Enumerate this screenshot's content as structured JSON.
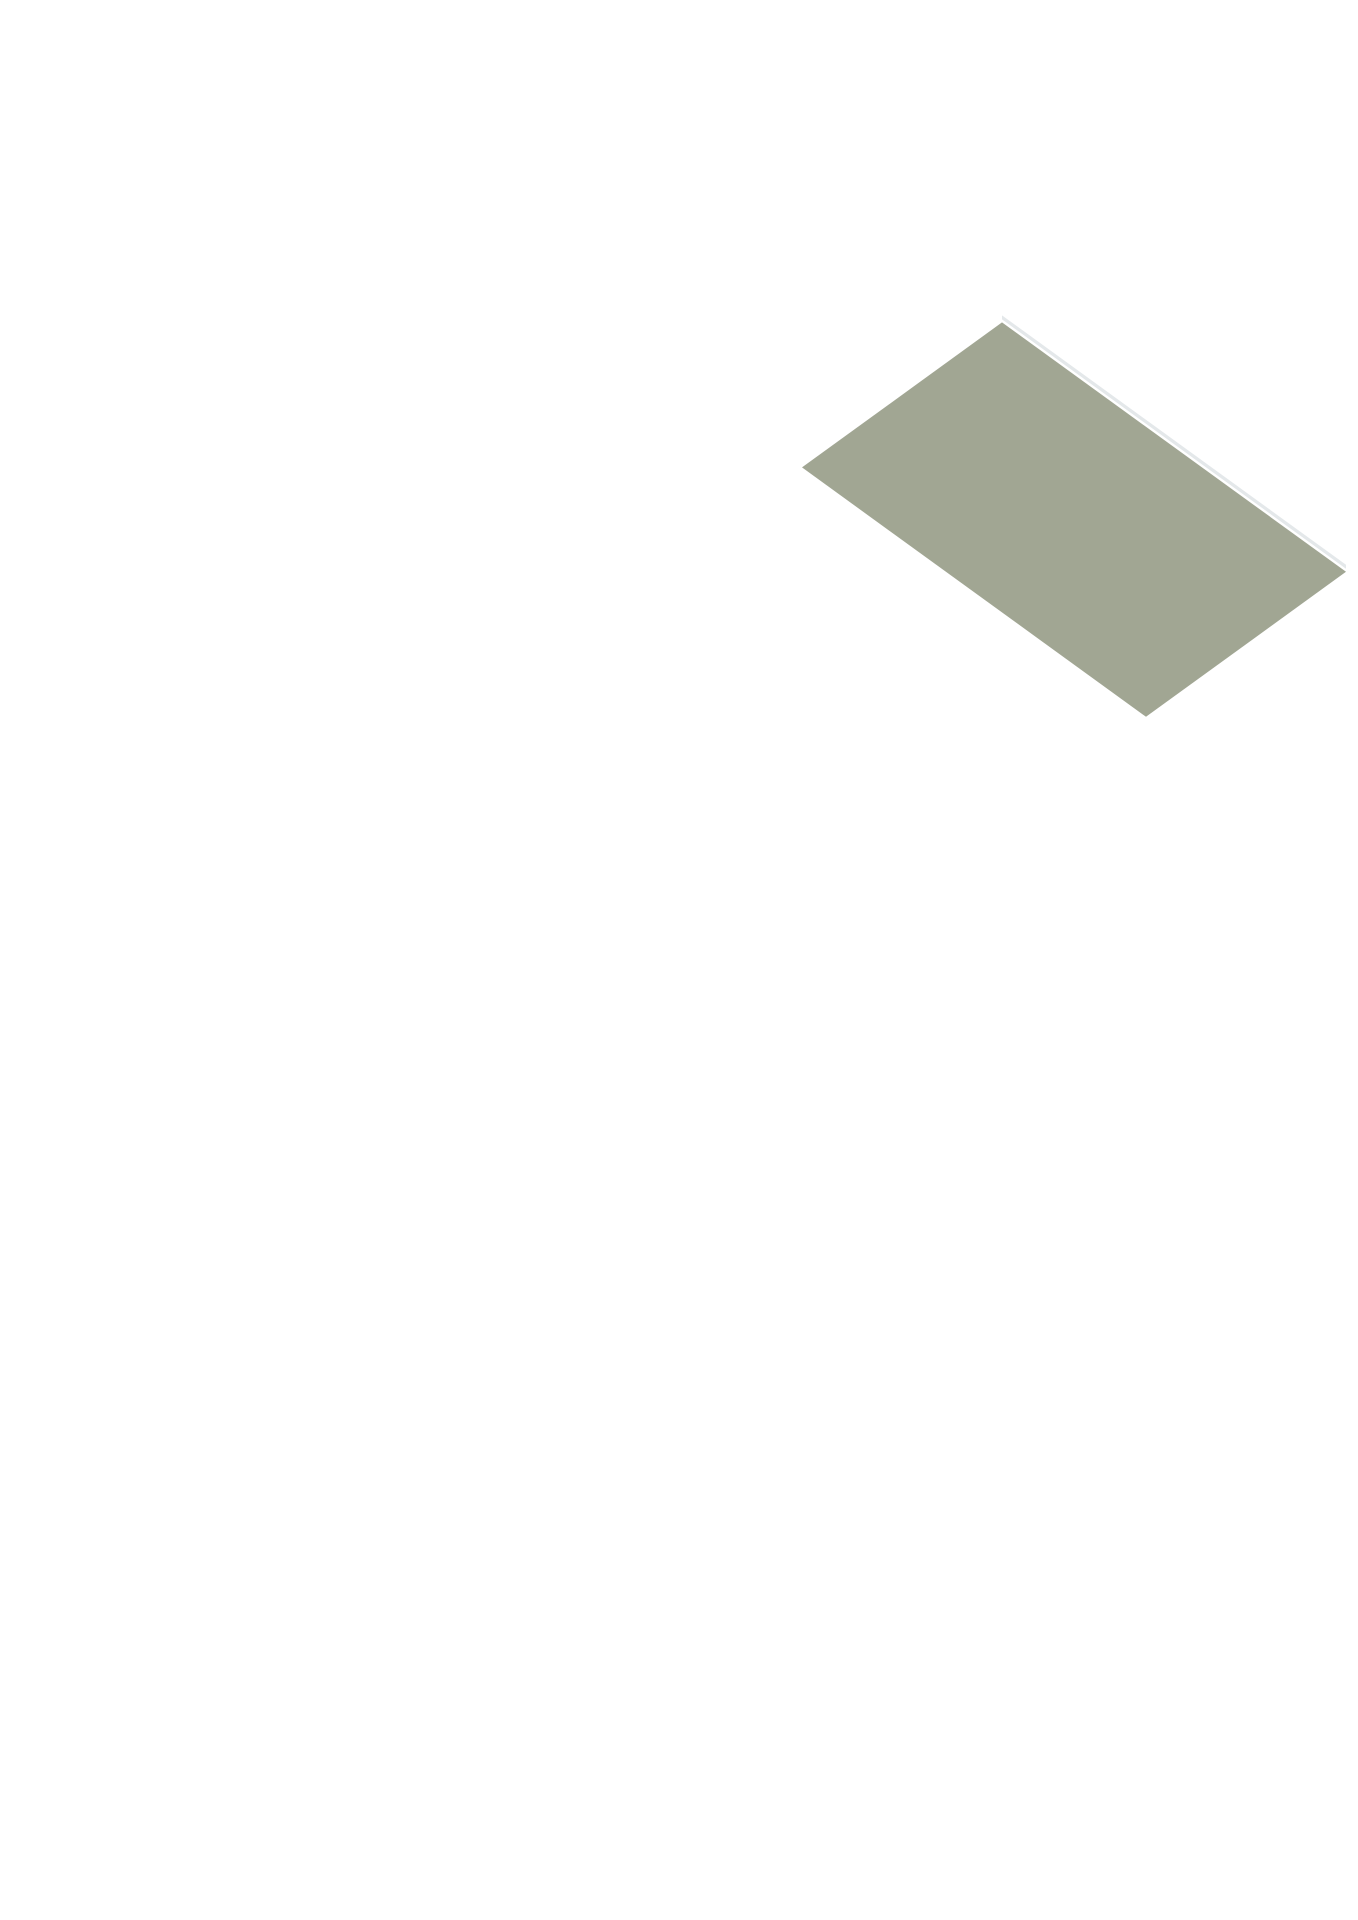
{
  "image": {
    "kind": "3d-floorplan-render",
    "background": "#ffffff"
  },
  "projection": {
    "ox": 778,
    "oy": 450,
    "ax": 0.8,
    "ay": 0.58
  },
  "colors": {
    "wallTop": "#303236",
    "extGray": "#c6c9cc",
    "intWhite": "#f3f4f6",
    "intGray": "#c0c4c7",
    "neInner": "#d0d3d5",
    "floorLiving": "#dfc8a2",
    "floorBed": "#d8bf95",
    "floorCorr": "#d9c098",
    "floorKitchen": "#ccd6de",
    "floorBath": "#c7d2dd",
    "floorTerrace": "#a1a693",
    "floorBalcony": "#d9dbdc",
    "glass": "#b4b8ab",
    "pane": "#eef1f3",
    "paneTan": "#d9c39b",
    "frame": "#ffffff",
    "door": "#e8eaeb",
    "doorGray": "#d9dcde",
    "rail": "#e4e8ea",
    "post": "#dde2e4",
    "white": "#f5f6f7",
    "boxFace": "#eceeef",
    "boxSide": "#e2e4e6",
    "stepFront": "#dfe2e4",
    "stepSide": "#d4d7d9",
    "applianceDark": "#27272a",
    "boilerFront": "#3c2b28",
    "boilerAccent": "#a33a2c",
    "handle": "#8e9498"
  },
  "scene": [
    {
      "t": "floor",
      "n": "terrace-floor",
      "pts": [
        [
          30,
          -250
        ],
        [
          460,
          -250
        ],
        [
          460,
          0
        ],
        [
          30,
          0
        ]
      ],
      "fill": "floorTerrace"
    },
    {
      "t": "rail",
      "n": "terrace-railing-nw",
      "axis": "x",
      "c": -250,
      "a1": 30,
      "a2": 460,
      "h": 55
    },
    {
      "t": "rail",
      "n": "terrace-railing-west",
      "axis": "y",
      "c": 30,
      "a1": -250,
      "a2": 0,
      "h": 55
    },
    {
      "t": "rail",
      "n": "terrace-railing-ne",
      "axis": "y",
      "c": 460,
      "a1": -250,
      "a2": 0,
      "h": 55
    },
    {
      "t": "rail",
      "n": "terrace-railing-se",
      "axis": "x",
      "c": 0,
      "a1": 390,
      "a2": 460,
      "h": 55
    },
    {
      "t": "wall",
      "n": "facade-ne-livingroom",
      "axis": "x",
      "c": -30,
      "th": 30,
      "a1": -30,
      "a2": 390,
      "h": 120,
      "face": "neInner",
      "panels": [
        {
          "n": "sliding-door-west",
          "u1": 75,
          "u2": 212,
          "z1": 0,
          "z2": 112,
          "fill": "glass",
          "frame": true,
          "mull": 2
        },
        {
          "n": "sliding-door-east",
          "u1": 228,
          "u2": 358,
          "z1": 0,
          "z2": 112,
          "fill": "glass",
          "frame": true,
          "mull": 2
        }
      ]
    },
    {
      "t": "wall",
      "n": "facade-nw",
      "axis": "y",
      "c": -30,
      "th": 30,
      "a1": 0,
      "a2": 945,
      "h": 120,
      "face": "intWhite",
      "panels": [
        {
          "n": "transom-window-1",
          "u1": 70,
          "u2": 114,
          "z1": 66,
          "z2": 104,
          "fill": "pane",
          "frame": true
        },
        {
          "n": "transom-window-2",
          "u1": 119,
          "u2": 163,
          "z1": 66,
          "z2": 104,
          "fill": "pane",
          "frame": true
        },
        {
          "n": "transom-window-3",
          "u1": 168,
          "u2": 212,
          "z1": 66,
          "z2": 104,
          "fill": "pane",
          "frame": true
        },
        {
          "n": "kitchen-window",
          "u1": 348,
          "u2": 426,
          "z1": 40,
          "z2": 98,
          "fill": "pane",
          "frame": true,
          "mull": 1
        },
        {
          "n": "dining-window",
          "u1": 558,
          "u2": 642,
          "z1": 34,
          "z2": 98,
          "fill": "pane",
          "frame": true,
          "mull": 1
        }
      ]
    },
    {
      "t": "floor",
      "n": "living-room-floor",
      "pts": [
        [
          0,
          0
        ],
        [
          390,
          0
        ],
        [
          390,
          440
        ],
        [
          250,
          440
        ],
        [
          250,
          335
        ],
        [
          0,
          335
        ]
      ],
      "fill": "floorLiving"
    },
    {
      "t": "floor",
      "n": "kitchen-floor",
      "pts": [
        [
          0,
          335
        ],
        [
          250,
          335
        ],
        [
          250,
          550
        ],
        [
          0,
          550
        ]
      ],
      "fill": "floorKitchen"
    },
    {
      "t": "floor",
      "n": "bathroom-floor",
      "pts": [
        [
          250,
          440
        ],
        [
          390,
          440
        ],
        [
          390,
          725
        ],
        [
          250,
          725
        ]
      ],
      "fill": "floorBath"
    },
    {
      "t": "floor",
      "n": "toilet-room-floor",
      "pts": [
        [
          170,
          550
        ],
        [
          250,
          550
        ],
        [
          250,
          725
        ],
        [
          170,
          725
        ]
      ],
      "fill": "floorBath"
    },
    {
      "t": "floor",
      "n": "dining-room-floor",
      "pts": [
        [
          0,
          550
        ],
        [
          170,
          550
        ],
        [
          170,
          725
        ],
        [
          390,
          725
        ],
        [
          390,
          915
        ],
        [
          0,
          915
        ]
      ],
      "fill": "floorLiving"
    },
    {
      "t": "box",
      "n": "kitchen-cabinet",
      "x1": 5,
      "y1": 350,
      "x2": 58,
      "y2": 530,
      "z1": 0,
      "z2": 62,
      "top": "white",
      "fx": "boxFace",
      "fy": "boxSide",
      "px": [
        {
          "n": "oven-appliance",
          "u1": 365,
          "u2": 412,
          "z1": 8,
          "z2": 54,
          "fill": "applianceDark"
        },
        {
          "n": "oven-appliance",
          "u1": 420,
          "u2": 462,
          "z1": 8,
          "z2": 54,
          "fill": "applianceDark"
        },
        {
          "n": "oven-appliance",
          "u1": 470,
          "u2": 515,
          "z1": 8,
          "z2": 54,
          "fill": "applianceDark"
        }
      ]
    },
    {
      "t": "stairs",
      "n": "staircase",
      "x1": 15,
      "x2": 95,
      "y0": 612,
      "d": 23,
      "steps": 7,
      "z0": 46,
      "dz": 6.3
    },
    {
      "t": "box",
      "n": "bathroom-sink-large",
      "x1": 315,
      "y1": 555,
      "x2": 385,
      "y2": 605,
      "z1": 0,
      "z2": 38,
      "top": "white",
      "fx": "boxFace",
      "fy": "boxSide"
    },
    {
      "t": "box",
      "n": "bathroom-sink-small",
      "x1": 283,
      "y1": 567,
      "x2": 312,
      "y2": 605,
      "z1": 0,
      "z2": 30,
      "top": "white",
      "fx": "boxFace",
      "fy": "boxSide"
    },
    {
      "t": "box",
      "n": "toilet-tank",
      "x1": 258,
      "y1": 625,
      "x2": 300,
      "y2": 639,
      "z1": 0,
      "z2": 42,
      "top": "white",
      "fx": "boxFace",
      "fy": "boxSide"
    },
    {
      "t": "box",
      "n": "toilet-bowl",
      "x1": 262,
      "y1": 639,
      "x2": 296,
      "y2": 674,
      "z1": 0,
      "z2": 26,
      "top": "white",
      "fx": "boxFace",
      "fy": "boxSide"
    },
    {
      "t": "wall",
      "n": "wall-kitchen-east",
      "axis": "y",
      "c": 250,
      "th": 22,
      "a1": 335,
      "a2": 550,
      "h": 118,
      "face": "intWhite",
      "panels": [
        {
          "n": "bathroom-door",
          "u1": 460,
          "u2": 518,
          "z1": 0,
          "z2": 100,
          "fill": "door",
          "frame": true
        }
      ]
    },
    {
      "t": "wall",
      "n": "wall-bathroom-north",
      "axis": "x",
      "c": 440,
      "th": 22,
      "a1": 272,
      "a2": 390,
      "h": 118,
      "face": "intGray"
    },
    {
      "t": "wall",
      "n": "wall-toilet-north",
      "axis": "x",
      "c": 550,
      "th": 22,
      "a1": 170,
      "a2": 272,
      "h": 118,
      "face": "intGray",
      "panels": [
        {
          "n": "toilet-door",
          "u1": 195,
          "u2": 248,
          "z1": 0,
          "z2": 100,
          "fill": "door",
          "frame": true
        }
      ]
    },
    {
      "t": "wall",
      "n": "wall-toilet-west",
      "axis": "y",
      "c": 148,
      "th": 22,
      "a1": 550,
      "a2": 747,
      "h": 118,
      "face": "intWhite"
    },
    {
      "t": "wall",
      "n": "wall-bath-toilet-divider",
      "axis": "y",
      "c": 250,
      "th": 22,
      "a1": 550,
      "a2": 725,
      "h": 118,
      "face": "intWhite"
    },
    {
      "t": "wall",
      "n": "wall-bathroom-south",
      "axis": "x",
      "c": 725,
      "th": 22,
      "a1": 148,
      "a2": 390,
      "h": 118,
      "face": "intGray"
    },
    {
      "t": "wall",
      "n": "facade-se-upper",
      "axis": "y",
      "c": 390,
      "th": 30,
      "a1": -30,
      "a2": 705,
      "h": 120,
      "ext": 50,
      "face": "intWhite",
      "panels": [
        {
          "n": "entrance-sidelight",
          "u1": 335,
          "u2": 347,
          "z1": 8,
          "z2": 106,
          "fill": "pane",
          "frame": true
        },
        {
          "n": "entrance-door",
          "u1": 352,
          "u2": 424,
          "z1": 0,
          "z2": 106,
          "fill": "door",
          "frame": true,
          "handle": true
        }
      ]
    },
    {
      "t": "wall",
      "n": "facade-sw-upper",
      "axis": "x",
      "c": 915,
      "th": 30,
      "a1": -30,
      "a2": 260,
      "h": 120,
      "ext": 50,
      "face": "extGray",
      "panels": [
        {
          "n": "balcony-window",
          "u1": 60,
          "u2": 245,
          "z1": 10,
          "z2": 112,
          "fill": "paneTan",
          "frame": true,
          "mull": 2
        }
      ]
    },
    {
      "t": "wall",
      "n": "wall-bedroom1-north",
      "axis": "x",
      "c": 915,
      "th": 30,
      "a1": 260,
      "a2": 500,
      "h": 120,
      "face": "intGray",
      "panels": [
        {
          "n": "bedroom1-door",
          "u1": 428,
          "u2": 484,
          "z1": 0,
          "z2": 102,
          "fill": "doorGray",
          "frame": true
        }
      ]
    },
    {
      "t": "floor",
      "n": "balcony-floor",
      "pts": [
        [
          75,
          945
        ],
        [
          225,
          945
        ],
        [
          225,
          1010
        ],
        [
          75,
          1010
        ]
      ],
      "fill": "floorBalcony"
    },
    {
      "t": "rail",
      "n": "balcony-railing-west",
      "axis": "y",
      "c": 75,
      "a1": 945,
      "a2": 1010,
      "h": 48
    },
    {
      "t": "rail",
      "n": "balcony-railing-south",
      "axis": "x",
      "c": 1010,
      "a1": 75,
      "a2": 225,
      "h": 48
    },
    {
      "t": "rail",
      "n": "balcony-railing-east",
      "axis": "y",
      "c": 225,
      "a1": 945,
      "a2": 1010,
      "h": 48
    },
    {
      "t": "floor",
      "n": "hallway-floor",
      "pts": [
        [
          390,
          705
        ],
        [
          915,
          705
        ],
        [
          915,
          860
        ],
        [
          500,
          860
        ],
        [
          500,
          915
        ],
        [
          390,
          915
        ]
      ],
      "fill": "floorCorr"
    },
    {
      "t": "floor",
      "n": "boiler-closet-floor",
      "pts": [
        [
          915,
          705
        ],
        [
          1015,
          705
        ],
        [
          1015,
          860
        ],
        [
          915,
          860
        ]
      ],
      "fill": "floorCorr"
    },
    {
      "t": "floor",
      "n": "bedroom1-floor",
      "pts": [
        [
          260,
          945
        ],
        [
          500,
          945
        ],
        [
          500,
          1130
        ],
        [
          260,
          1130
        ]
      ],
      "fill": "floorBed"
    },
    {
      "t": "floor",
      "n": "bedroom2-floor",
      "pts": [
        [
          500,
          882
        ],
        [
          700,
          882
        ],
        [
          700,
          1130
        ],
        [
          500,
          1130
        ]
      ],
      "fill": "floorBed"
    },
    {
      "t": "floor",
      "n": "bedroom3-floor",
      "pts": [
        [
          700,
          882
        ],
        [
          1015,
          882
        ],
        [
          1015,
          1130
        ],
        [
          700,
          1130
        ]
      ],
      "fill": "floorBed"
    },
    {
      "t": "box",
      "n": "washing-machine",
      "x1": 612,
      "y1": 712,
      "x2": 678,
      "y2": 778,
      "z1": 0,
      "z2": 55,
      "top": "white",
      "fx": "boxFace",
      "fy": "boxFace"
    },
    {
      "t": "circle",
      "n": "washing-machine-door",
      "x": 645,
      "y": 778,
      "z": 27,
      "r": 13,
      "fill": "boxFace",
      "stroke": "#c6c9cb",
      "r2": 8,
      "fill2": "#ced2d4"
    },
    {
      "t": "box",
      "n": "boiler-unit",
      "x1": 930,
      "y1": 708,
      "x2": 1002,
      "y2": 758,
      "z1": 35,
      "z2": 108,
      "top": "white",
      "fx": "intWhite",
      "fy": "white",
      "py": [
        {
          "n": "boiler-front-panel",
          "u1": 938,
          "u2": 996,
          "z1": 46,
          "z2": 100,
          "fill": "boilerFront"
        },
        {
          "n": "boiler-accent-strip",
          "u1": 938,
          "u2": 996,
          "z1": 40,
          "z2": 46,
          "fill": "boilerAccent"
        }
      ]
    },
    {
      "t": "wall",
      "n": "wall-closet-a",
      "axis": "y",
      "c": 600,
      "th": 22,
      "a1": 705,
      "a2": 852,
      "h": 118,
      "face": "intWhite"
    },
    {
      "t": "wall",
      "n": "wall-closet-b",
      "axis": "y",
      "c": 700,
      "th": 22,
      "a1": 705,
      "a2": 852,
      "h": 118,
      "face": "intWhite"
    },
    {
      "t": "wall",
      "n": "wall-hallway-south",
      "axis": "x",
      "c": 860,
      "th": 22,
      "a1": 500,
      "a2": 1015,
      "h": 118,
      "face": "intGray",
      "panels": [
        {
          "n": "bedroom2-door",
          "u1": 514,
          "u2": 568,
          "z1": 0,
          "z2": 102,
          "fill": "doorGray",
          "frame": true
        },
        {
          "n": "closet-door",
          "u1": 610,
          "u2": 664,
          "z1": 0,
          "z2": 102,
          "fill": "doorGray",
          "frame": true
        },
        {
          "n": "bedroom3-door",
          "u1": 714,
          "u2": 768,
          "z1": 0,
          "z2": 102,
          "fill": "doorGray",
          "frame": true
        }
      ]
    },
    {
      "t": "wall",
      "n": "wall-boiler-west",
      "axis": "y",
      "c": 893,
      "th": 22,
      "a1": 705,
      "a2": 830,
      "h": 118,
      "face": "intWhite"
    },
    {
      "t": "wall",
      "n": "wall-bedroom-divider",
      "axis": "y",
      "c": 700,
      "th": 22,
      "a1": 882,
      "a2": 1130,
      "h": 118,
      "face": "intWhite"
    },
    {
      "t": "wall",
      "n": "wall-boiler-south",
      "axis": "x",
      "c": 830,
      "th": 22,
      "a1": 893,
      "a2": 1015,
      "h": 118,
      "face": "intGray"
    },
    {
      "t": "wall",
      "n": "facade-ne-lower",
      "axis": "x",
      "c": 675,
      "th": 30,
      "a1": 390,
      "a2": 1045,
      "h": 120,
      "face": "intGray",
      "panels": [
        {
          "n": "hall-closet-door-1",
          "u1": 430,
          "u2": 484,
          "z1": 0,
          "z2": 102,
          "fill": "doorGray",
          "frame": true
        },
        {
          "n": "hall-closet-door-2",
          "u1": 700,
          "u2": 752,
          "z1": 0,
          "z2": 102,
          "fill": "doorGray",
          "frame": true
        },
        {
          "n": "hall-closet-door-3",
          "u1": 758,
          "u2": 810,
          "z1": 0,
          "z2": 102,
          "fill": "doorGray",
          "frame": true
        }
      ]
    },
    {
      "t": "wall",
      "n": "facade-west-lower",
      "axis": "y",
      "c": 230,
      "th": 30,
      "a1": 915,
      "a2": 1160,
      "h": 120,
      "face": "intWhite"
    },
    {
      "t": "wall",
      "n": "facade-se-lower",
      "axis": "y",
      "c": 1015,
      "th": 30,
      "a1": 675,
      "a2": 1160,
      "h": 120,
      "ext": 50,
      "face": "intWhite"
    },
    {
      "t": "wall",
      "n": "facade-sw-lower",
      "axis": "x",
      "c": 1130,
      "th": 30,
      "a1": 230,
      "a2": 1045,
      "h": 120,
      "ext": 50,
      "face": "extGray",
      "panels": [
        {
          "n": "bedroom1-window",
          "u1": 300,
          "u2": 400,
          "z1": 25,
          "z2": 98,
          "fill": "paneTan",
          "frame": true,
          "mull": 1
        },
        {
          "n": "bedroom2-window",
          "u1": 525,
          "u2": 620,
          "z1": 25,
          "z2": 98,
          "fill": "paneTan",
          "frame": true,
          "mull": 1
        },
        {
          "n": "bedroom3-window-1",
          "u1": 740,
          "u2": 840,
          "z1": 25,
          "z2": 98,
          "fill": "paneTan",
          "frame": true,
          "mull": 1
        },
        {
          "n": "bedroom3-window-2",
          "u1": 880,
          "u2": 980,
          "z1": 25,
          "z2": 98,
          "fill": "paneTan",
          "frame": true,
          "mull": 1
        }
      ]
    }
  ]
}
